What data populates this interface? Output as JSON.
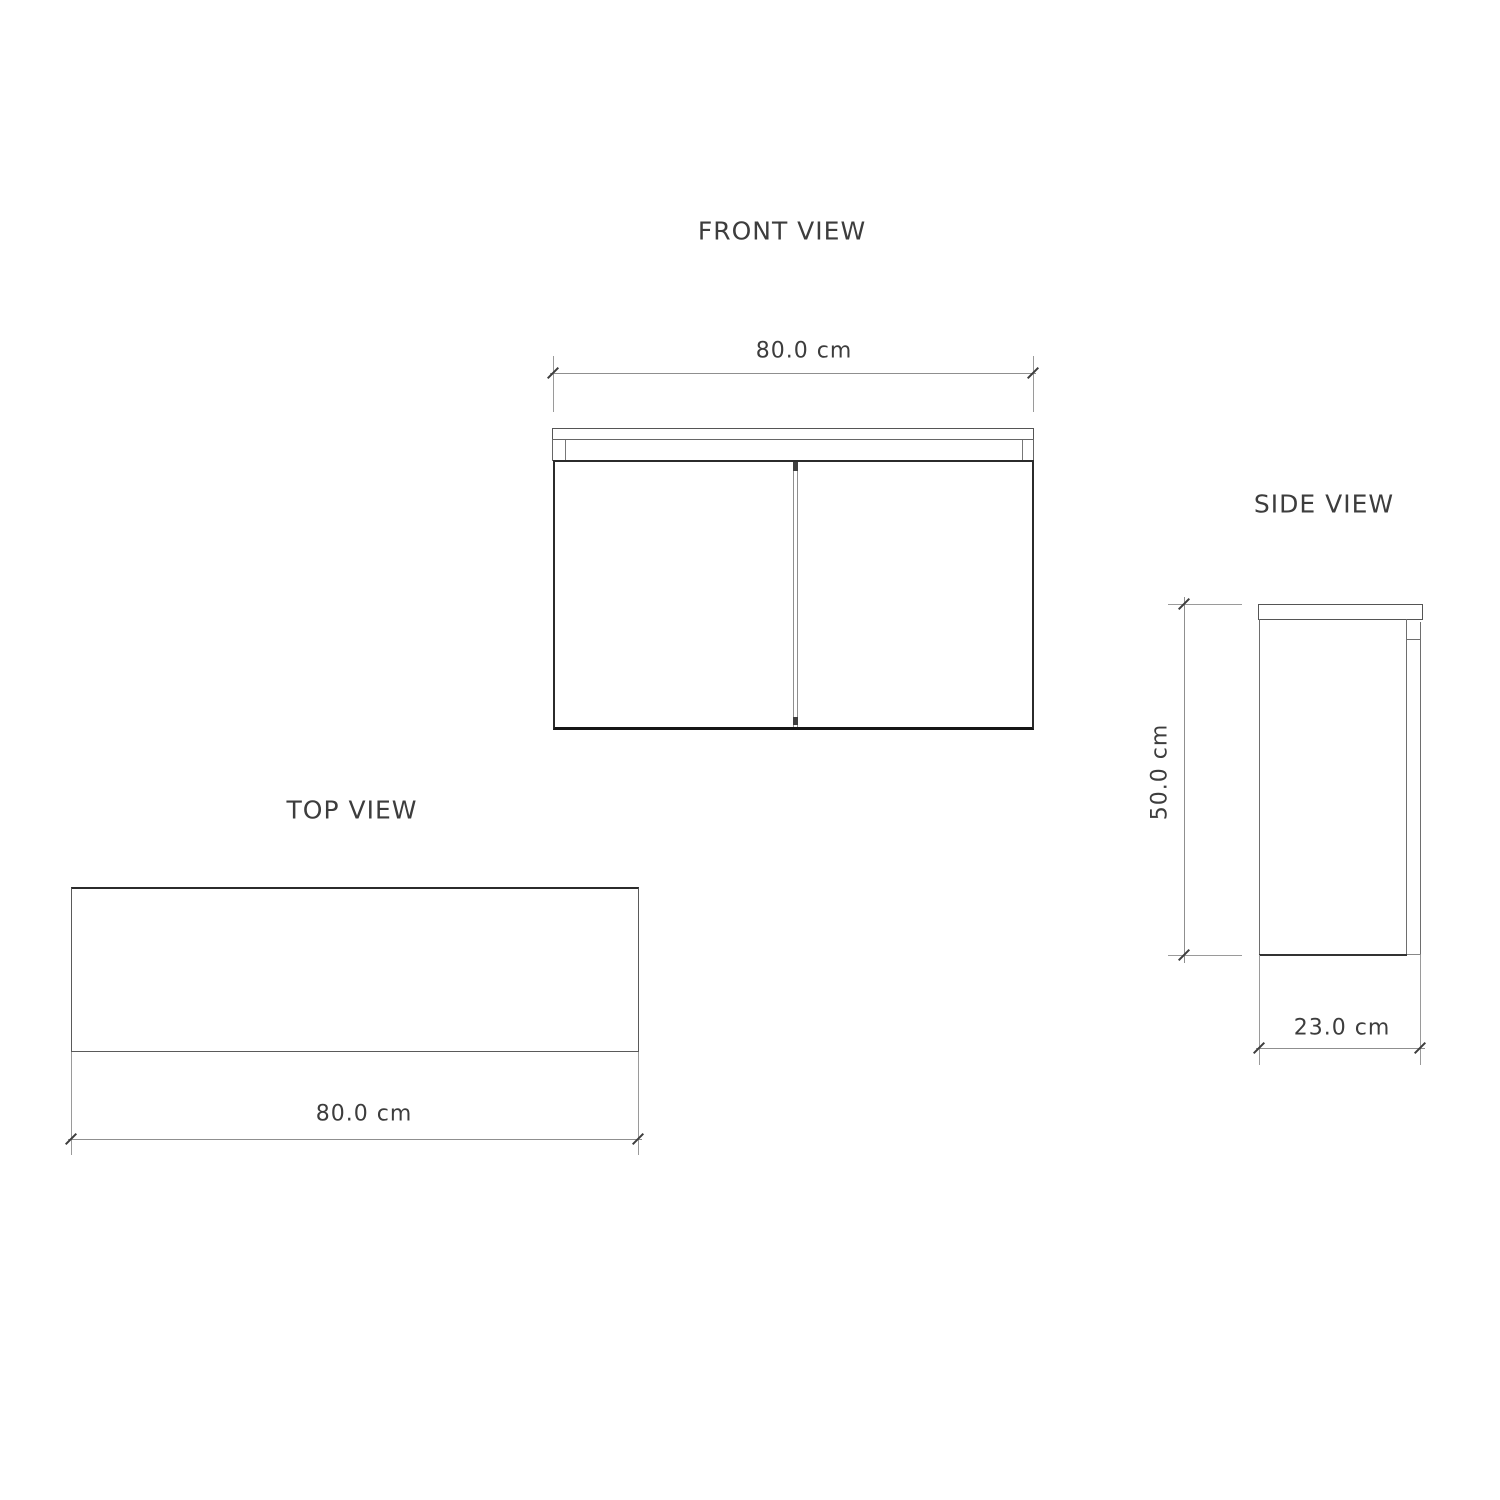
{
  "drawing_title": "cabinet orthographic views",
  "views": {
    "front": {
      "title": "FRONT VIEW",
      "width_label": "80.0 cm"
    },
    "side": {
      "title": "SIDE VIEW",
      "height_label": "50.0 cm",
      "depth_label": "23.0 cm"
    },
    "top": {
      "title": "TOP VIEW",
      "width_label": "80.0 cm"
    }
  },
  "dimensions_cm": {
    "width": 80.0,
    "height": 50.0,
    "depth": 23.0
  },
  "colors": {
    "background": "#ffffff",
    "text": "#3d3d3d",
    "object_line": "#6e6e6e",
    "heavy_outline": "#2b2b2b",
    "dimension_line": "#8f8f8f",
    "tick": "#3d3d3d"
  }
}
